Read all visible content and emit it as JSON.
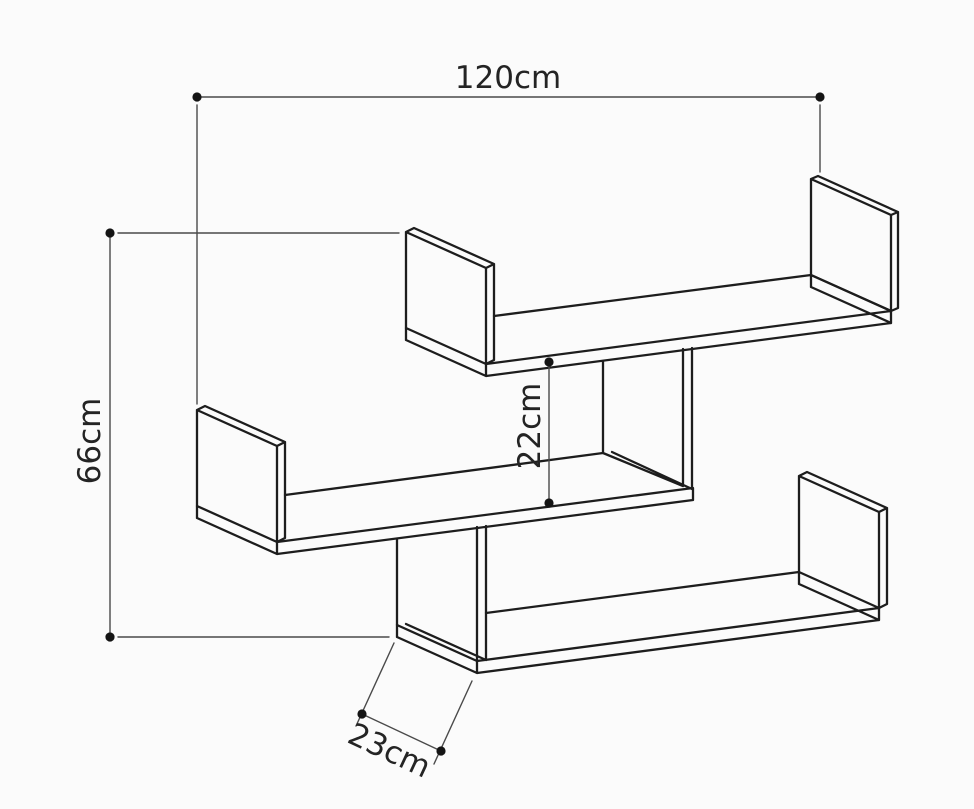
{
  "diagram": {
    "subject": "three-tier zigzag wall shelf dimension drawing",
    "unit": "cm",
    "dimensions": {
      "width_label": "120cm",
      "height_label": "66cm",
      "gap_label": "22cm",
      "depth_label": "23cm",
      "width_cm": 120,
      "height_cm": 66,
      "gap_cm": 22,
      "depth_cm": 23
    },
    "colors": {
      "outline": "#1d1d1d",
      "dimension_line": "#4a4a4a",
      "text": "#242424",
      "background": "#fbfbfb"
    }
  }
}
